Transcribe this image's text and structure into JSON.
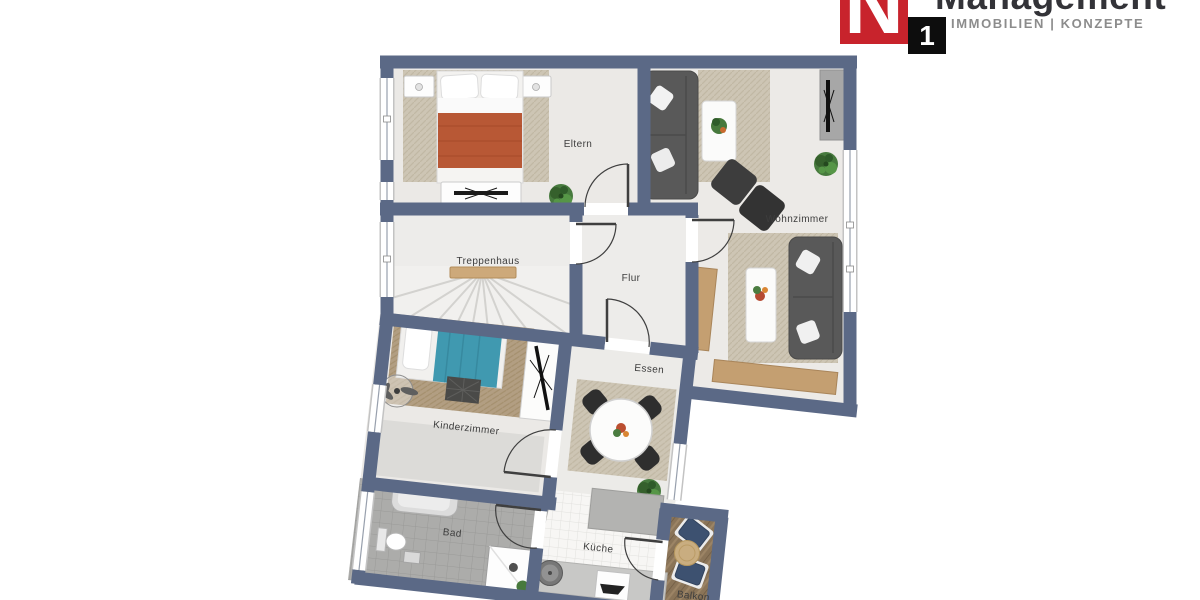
{
  "logo": {
    "letter": "N",
    "number": "1",
    "brand": "Management",
    "tagline": "IMMOBILIEN | KONZEPTE",
    "red": "#c8232c",
    "black": "#0d0d0d"
  },
  "floorplan": {
    "rooms": [
      {
        "id": "eltern",
        "label": "Eltern"
      },
      {
        "id": "wohnzimmer",
        "label": "Wohnzimmer"
      },
      {
        "id": "treppenhaus",
        "label": "Treppenhaus"
      },
      {
        "id": "flur",
        "label": "Flur"
      },
      {
        "id": "essen",
        "label": "Essen"
      },
      {
        "id": "kinderzimmer",
        "label": "Kinderzimmer"
      },
      {
        "id": "bad",
        "label": "Bad"
      },
      {
        "id": "kueche",
        "label": "Küche"
      },
      {
        "id": "balkon",
        "label": "Balkon"
      }
    ],
    "colors": {
      "wall": "#5b6986",
      "floor": "#ebe9e6",
      "bed_blanket_parents": "#b85835",
      "bed_blanket_child": "#4099b0",
      "wood": "#c49f71",
      "sofa": "#595959"
    }
  }
}
